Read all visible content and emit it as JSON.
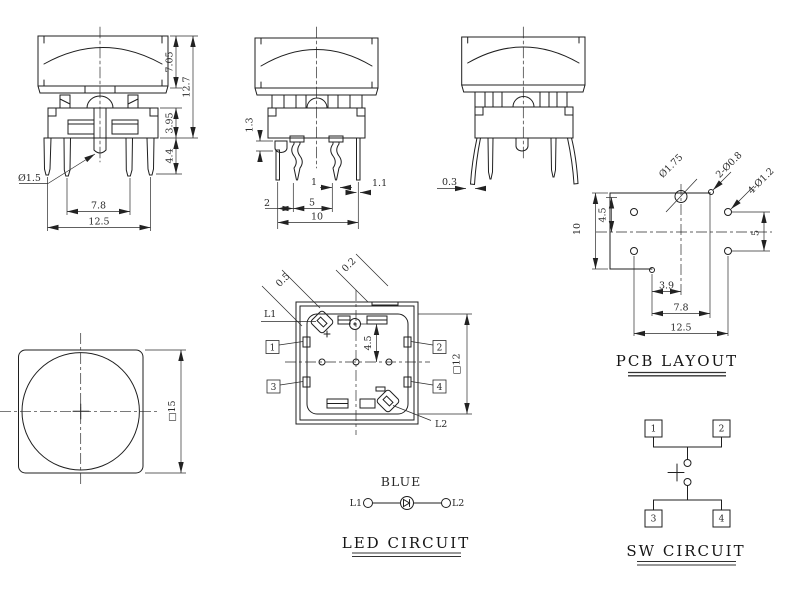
{
  "drawing": {
    "side_a": {
      "dims": {
        "cap_height": "7.05",
        "total_height": "12.7",
        "body_height": "3.95",
        "pin_length": "4.4",
        "pin_dia": "Ø1.5",
        "inner_pitch": "7.8",
        "outer_pitch": "12.5"
      }
    },
    "side_b": {
      "dims": {
        "boss_height": "1.3",
        "pin_width": "1",
        "pin_width_right": "1.1",
        "offset": "2",
        "contact_pitch": "5",
        "span": "10"
      }
    },
    "side_c": {
      "dims": {
        "tip_thickness": "0.3"
      }
    },
    "front": {
      "dims": {
        "size": "□15"
      }
    },
    "top": {
      "labels": {
        "led1": "L1",
        "led2": "L2",
        "pin1": "1",
        "pin2": "2",
        "pin3": "3",
        "pin4": "4"
      },
      "dims": {
        "slot": "0.5",
        "notch": "0.2",
        "center_offset": "4.5",
        "size": "□12"
      }
    },
    "pcb": {
      "title": "PCB LAYOUT",
      "callouts": {
        "main_hole": "Ø1.75",
        "led_holes": "2-Ø0.8",
        "mount_holes": "4-Ø1.2"
      },
      "dims": {
        "top_offset": "4.5",
        "height": "10",
        "right_pitch": "5",
        "a": "3.9",
        "b": "7.8",
        "c": "12.5"
      }
    },
    "led": {
      "title": "LED CIRCUIT",
      "color_label": "BLUE",
      "terminal1": "L1",
      "terminal2": "L2"
    },
    "sw": {
      "title": "SW CIRCUIT",
      "pins": {
        "p1": "1",
        "p2": "2",
        "p3": "3",
        "p4": "4"
      }
    }
  }
}
